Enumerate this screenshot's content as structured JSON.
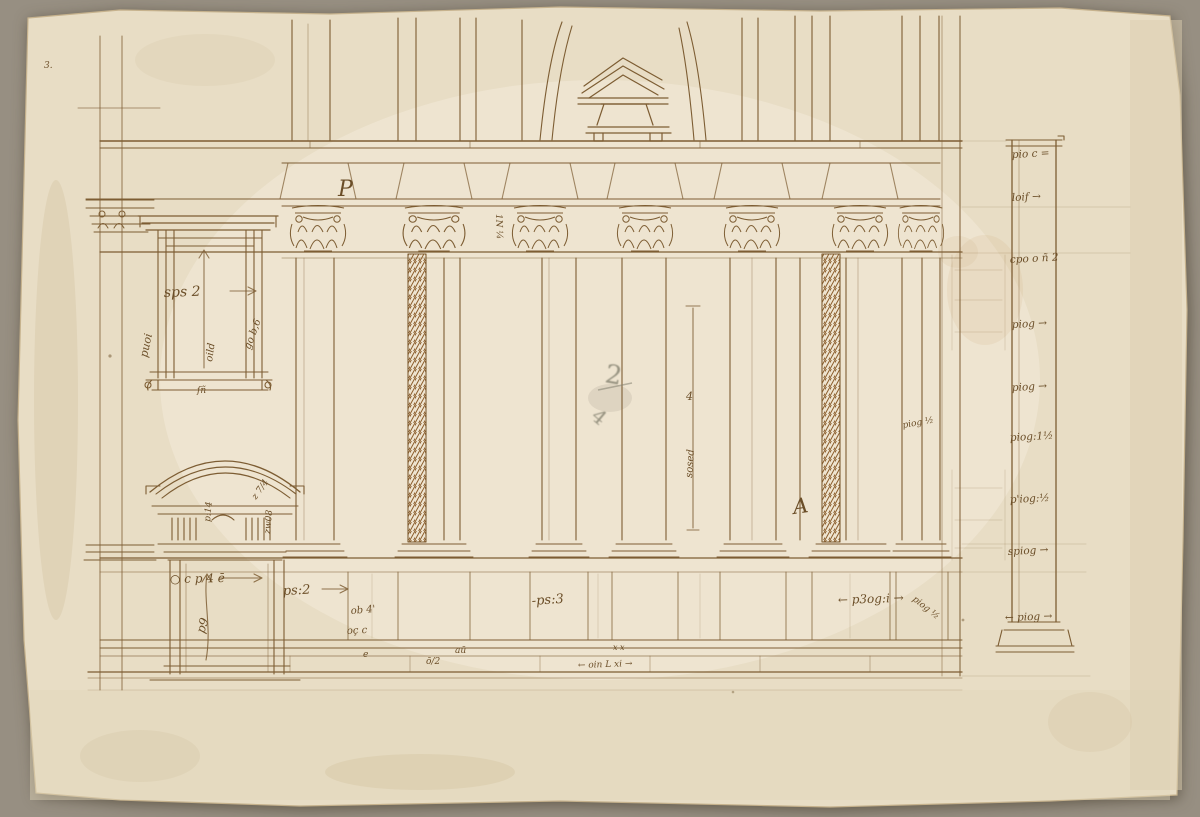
{
  "colors": {
    "background": "#978f82",
    "paper": "#e8ddc5",
    "paper_light": "#f2ead8",
    "ink": "#7d5d33",
    "ink_dark": "#5c4122",
    "handwriting": "#6b4e28",
    "pencil": "#83806f",
    "stain": "#c8a670"
  },
  "annotations": [
    {
      "id": "p-mark",
      "text": "P",
      "x": 338,
      "y": 196,
      "rot": 0,
      "size": 22
    },
    {
      "id": "frieze-dim",
      "text": "1N ¼",
      "x": 496,
      "y": 214,
      "rot": 88,
      "size": 9
    },
    {
      "id": "window-width",
      "text": "sps 2",
      "x": 164,
      "y": 297,
      "rot": -2,
      "size": 14
    },
    {
      "id": "window-left-dim",
      "text": "puoi",
      "x": 147,
      "y": 358,
      "rot": -78,
      "size": 11
    },
    {
      "id": "window-height-dim",
      "text": "oild",
      "x": 212,
      "y": 362,
      "rot": -82,
      "size": 10
    },
    {
      "id": "window-right-dim",
      "text": "go b,6",
      "x": 250,
      "y": 350,
      "rot": -70,
      "size": 10
    },
    {
      "id": "window-sill-mark",
      "text": "ſñ",
      "x": 197,
      "y": 393,
      "rot": 0,
      "size": 9
    },
    {
      "id": "door-frieze-dim",
      "text": "p:14",
      "x": 210,
      "y": 522,
      "rot": -85,
      "size": 9
    },
    {
      "id": "door-cornice-mark",
      "text": "z 7/4",
      "x": 256,
      "y": 500,
      "rot": -55,
      "size": 9
    },
    {
      "id": "door-right-mark",
      "text": "zw08",
      "x": 270,
      "y": 534,
      "rot": -85,
      "size": 9
    },
    {
      "id": "door-width",
      "text": "○ c p 4 ē",
      "x": 170,
      "y": 583,
      "rot": -1,
      "size": 12
    },
    {
      "id": "door-height",
      "text": "p9",
      "x": 204,
      "y": 634,
      "rot": -72,
      "size": 12
    },
    {
      "id": "pedestal-width-1",
      "text": "ps:2",
      "x": 283,
      "y": 595,
      "rot": -3,
      "size": 13
    },
    {
      "id": "pedestal-mark-1",
      "text": "ob 4'",
      "x": 351,
      "y": 614,
      "rot": -5,
      "size": 10
    },
    {
      "id": "pedestal-mark-2",
      "text": "oç c",
      "x": 347,
      "y": 634,
      "rot": -3,
      "size": 10
    },
    {
      "id": "plinth-mark-e",
      "text": "e",
      "x": 363,
      "y": 657,
      "rot": 0,
      "size": 9
    },
    {
      "id": "plinth-mark-frac",
      "text": "ō/2",
      "x": 426,
      "y": 664,
      "rot": 0,
      "size": 9
    },
    {
      "id": "plinth-mark-av",
      "text": "aū",
      "x": 455,
      "y": 653,
      "rot": 0,
      "size": 9
    },
    {
      "id": "pedestal-width-2",
      "text": "-ps:3",
      "x": 532,
      "y": 605,
      "rot": -4,
      "size": 13
    },
    {
      "id": "plinth-xx",
      "text": "x x",
      "x": 613,
      "y": 650,
      "rot": 0,
      "size": 8
    },
    {
      "id": "plinth-dim",
      "text": "← oin L xi →",
      "x": 578,
      "y": 668,
      "rot": -2,
      "size": 9
    },
    {
      "id": "column-dim-top",
      "text": "4",
      "x": 686,
      "y": 400,
      "rot": 0,
      "size": 11
    },
    {
      "id": "column-dim",
      "text": "sosed",
      "x": 692,
      "y": 478,
      "rot": -86,
      "size": 10
    },
    {
      "id": "a-mark",
      "text": "A",
      "x": 794,
      "y": 514,
      "rot": -8,
      "size": 21
    },
    {
      "id": "pedestal-width-3",
      "text": "← p3og:i →",
      "x": 838,
      "y": 604,
      "rot": -2,
      "size": 12
    },
    {
      "id": "pier-mark",
      "text": "piog ½",
      "x": 912,
      "y": 600,
      "rot": 38,
      "size": 9
    },
    {
      "id": "shaft-mark",
      "text": "piog ½",
      "x": 903,
      "y": 428,
      "rot": -10,
      "size": 9
    },
    {
      "id": "page-mark",
      "text": "3.",
      "x": 44,
      "y": 68,
      "rot": 0,
      "size": 9
    },
    {
      "id": "scale-1",
      "text": "pio c =",
      "x": 1012,
      "y": 158,
      "rot": -3,
      "size": 10.5
    },
    {
      "id": "scale-2",
      "text": "loif →",
      "x": 1012,
      "y": 201,
      "rot": -3,
      "size": 10.5
    },
    {
      "id": "scale-3",
      "text": "cpo o ñ 2",
      "x": 1010,
      "y": 263,
      "rot": -3,
      "size": 10.5
    },
    {
      "id": "scale-4",
      "text": "piog →",
      "x": 1012,
      "y": 328,
      "rot": -3,
      "size": 10.5
    },
    {
      "id": "scale-5",
      "text": "piog →",
      "x": 1012,
      "y": 391,
      "rot": -3,
      "size": 10.5
    },
    {
      "id": "scale-6",
      "text": "piog:1½",
      "x": 1010,
      "y": 441,
      "rot": -3,
      "size": 10.5
    },
    {
      "id": "scale-7",
      "text": "p'iog:½",
      "x": 1010,
      "y": 503,
      "rot": -3,
      "size": 10.5
    },
    {
      "id": "scale-8",
      "text": "spiog →",
      "x": 1008,
      "y": 555,
      "rot": -3,
      "size": 10.5
    },
    {
      "id": "scale-9",
      "text": "← piog →",
      "x": 1005,
      "y": 621,
      "rot": -2,
      "size": 10.5
    },
    {
      "id": "pencil-2",
      "text": "2",
      "x": 604,
      "y": 382,
      "rot": 10,
      "size": 26,
      "pen": "pencil"
    },
    {
      "id": "pencil-4",
      "text": "4",
      "x": 590,
      "y": 418,
      "rot": 40,
      "size": 20,
      "pen": "pencil"
    }
  ]
}
